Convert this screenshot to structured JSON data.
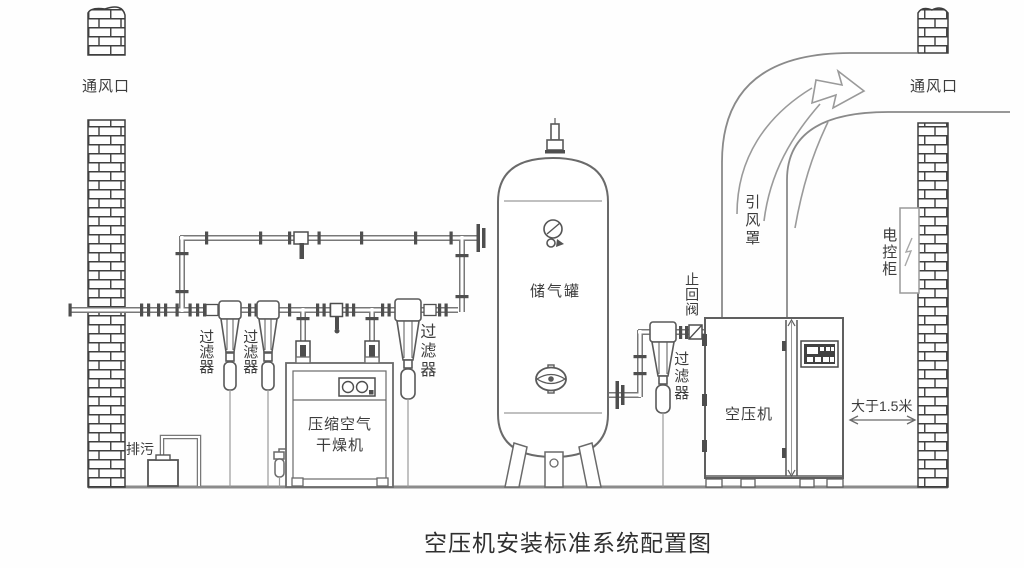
{
  "diagram": {
    "title": "空压机安装标准系统配置图",
    "labels": {
      "vent_left": "通风口",
      "vent_right": "通风口",
      "filter": "过滤器",
      "drain": "排污",
      "dryer_line1": "压缩空气",
      "dryer_line2": "干燥机",
      "tank": "储气罐",
      "check_valve": "止回阀",
      "compressor": "空压机",
      "duct_hood": "引风罩",
      "control_cabinet": "电控柜",
      "distance": "大于1.5米"
    },
    "colors": {
      "pipe_line": "#787878",
      "detail_line": "#4e4e4e",
      "brick_line": "#3e3e3e",
      "text": "#3c3c3c",
      "background": "#ffffff"
    }
  }
}
